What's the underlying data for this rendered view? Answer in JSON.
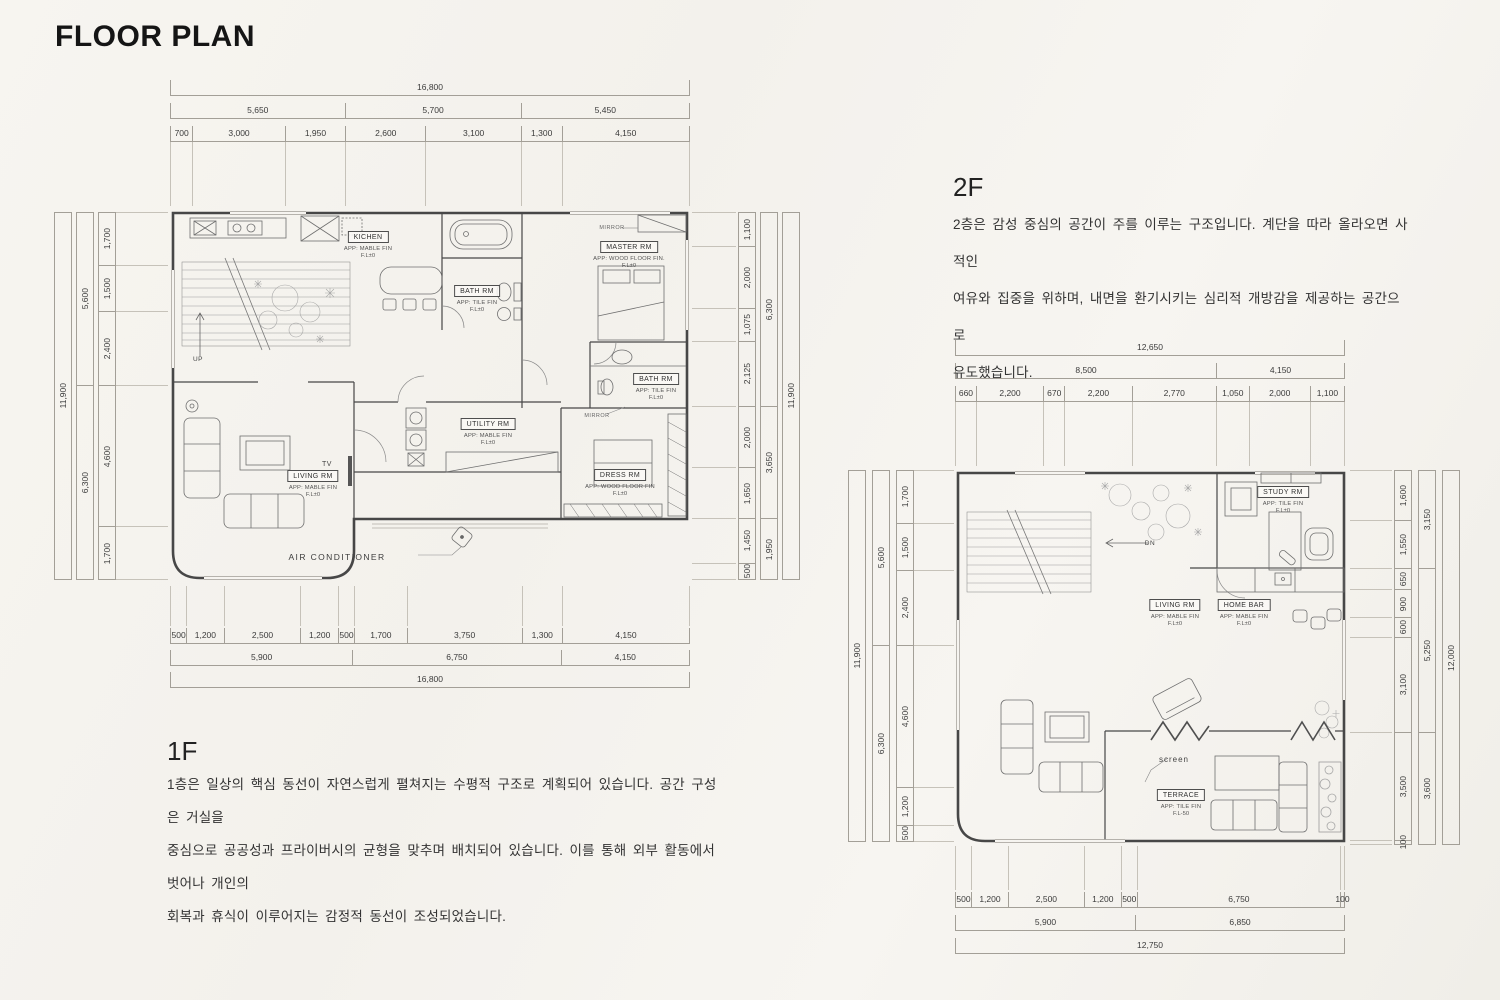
{
  "page": {
    "title": "FLOOR PLAN"
  },
  "floor1": {
    "heading": "1F",
    "description": "1층은 일상의 핵심 동선이 자연스럽게 펼쳐지는 수평적 구조로 계획되어 있습니다. 공간 구성은 거실을\n중심으로 공공성과 프라이버시의 균형을 맞추며 배치되어 있습니다. 이를 통해 외부 활동에서 벗어나 개인의\n회복과 휴식이 이루어지는 감정적 동선이 조성되었습니다.",
    "rooms": [
      {
        "name": "KICHEN",
        "fin": "APP: MABLE FIN",
        "lvl": "F.L±0"
      },
      {
        "name": "BATH RM",
        "fin": "APP: TILE FIN",
        "lvl": "F.L±0"
      },
      {
        "name": "MASTER RM",
        "fin": "APP: WOOD FLOOR FIN.",
        "lvl": "F.L±0"
      },
      {
        "name": "BATH RM",
        "fin": "APP: TILE FIN",
        "lvl": "F.L±0"
      },
      {
        "name": "UTILITY RM",
        "fin": "APP: MABLE FIN",
        "lvl": "F.L±0"
      },
      {
        "name": "LIVING RM",
        "fin": "APP: MABLE FIN",
        "lvl": "F.L±0"
      },
      {
        "name": "DRESS RM",
        "fin": "APP: WOOD FLOOR FIN",
        "lvl": "F.L±0"
      }
    ],
    "ann": {
      "up": "UP",
      "tv": "TV",
      "mirror_top": "MIRROR",
      "mirror_mid": "MIRROR",
      "aircon": "AIR CONDITIONER"
    },
    "dims": {
      "top_total": [
        {
          "t": "16,800",
          "s": 16800
        }
      ],
      "top_group": [
        {
          "t": "5,650",
          "s": 5650
        },
        {
          "t": "5,700",
          "s": 5700
        },
        {
          "t": "5,450",
          "s": 5450
        }
      ],
      "top_detail": [
        {
          "t": "700",
          "s": 700
        },
        {
          "t": "3,000",
          "s": 3000
        },
        {
          "t": "1,950",
          "s": 1950
        },
        {
          "t": "2,600",
          "s": 2600
        },
        {
          "t": "3,100",
          "s": 3100
        },
        {
          "t": "1,300",
          "s": 1300
        },
        {
          "t": "4,150",
          "s": 4150
        }
      ],
      "bottom_detail": [
        {
          "t": "500",
          "s": 500
        },
        {
          "t": "1,200",
          "s": 1200
        },
        {
          "t": "2,500",
          "s": 2500
        },
        {
          "t": "1,200",
          "s": 1200
        },
        {
          "t": "500",
          "s": 500
        },
        {
          "t": "1,700",
          "s": 1700
        },
        {
          "t": "3,750",
          "s": 3750
        },
        {
          "t": "1,300",
          "s": 1300
        },
        {
          "t": "4,150",
          "s": 4150
        }
      ],
      "bottom_group": [
        {
          "t": "5,900",
          "s": 5900
        },
        {
          "t": "6,750",
          "s": 6750
        },
        {
          "t": "4,150",
          "s": 4150
        }
      ],
      "bottom_total": [
        {
          "t": "16,800",
          "s": 16800
        }
      ],
      "left_total": [
        {
          "t": "11,900",
          "s": 11900
        }
      ],
      "left_group": [
        {
          "t": "5,600",
          "s": 5600
        },
        {
          "t": "6,300",
          "s": 6300
        }
      ],
      "left_detail": [
        {
          "t": "1,700",
          "s": 1700
        },
        {
          "t": "1,500",
          "s": 1500
        },
        {
          "t": "2,400",
          "s": 2400
        },
        {
          "t": "4,600",
          "s": 4600
        },
        {
          "t": "1,700",
          "s": 1700
        }
      ],
      "right_detail": [
        {
          "t": "1,100",
          "s": 1100
        },
        {
          "t": "2,000",
          "s": 2000
        },
        {
          "t": "1,075",
          "s": 1075
        },
        {
          "t": "2,125",
          "s": 2125
        },
        {
          "t": "2,000",
          "s": 2000
        },
        {
          "t": "1,650",
          "s": 1650
        },
        {
          "t": "1,450",
          "s": 1450
        },
        {
          "t": "500",
          "s": 500
        }
      ],
      "right_group": [
        {
          "t": "6,300",
          "s": 6300
        },
        {
          "t": "3,650",
          "s": 3650
        },
        {
          "t": "1,950",
          "s": 1950
        }
      ],
      "right_total": [
        {
          "t": "11,900",
          "s": 11900
        }
      ]
    }
  },
  "floor2": {
    "heading": "2F",
    "description": "2층은 감성 중심의 공간이 주를 이루는 구조입니다. 계단을 따라 올라오면 사적인\n여유와 집중을 위하며, 내면을 환기시키는 심리적 개방감을 제공하는 공간으로\n유도했습니다.",
    "rooms": [
      {
        "name": "STUDY RM",
        "fin": "APP: TILE FIN",
        "lvl": "F.L±0"
      },
      {
        "name": "LIVING RM",
        "fin": "APP: MABLE FIN",
        "lvl": "F.L±0"
      },
      {
        "name": "HOME BAR",
        "fin": "APP: MABLE FIN",
        "lvl": "F.L±0"
      },
      {
        "name": "TERRACE",
        "fin": "APP: TILE FIN",
        "lvl": "F.L-50"
      }
    ],
    "ann": {
      "dn": "DN",
      "screen": "screen"
    },
    "dims": {
      "top_total": [
        {
          "t": "12,650",
          "s": 12650
        }
      ],
      "top_group": [
        {
          "t": "8,500",
          "s": 8500
        },
        {
          "t": "4,150",
          "s": 4150
        }
      ],
      "top_detail": [
        {
          "t": "660",
          "s": 660
        },
        {
          "t": "2,200",
          "s": 2200
        },
        {
          "t": "670",
          "s": 670
        },
        {
          "t": "2,200",
          "s": 2200
        },
        {
          "t": "2,770",
          "s": 2770
        },
        {
          "t": "1,050",
          "s": 1050
        },
        {
          "t": "2,000",
          "s": 2000
        },
        {
          "t": "1,100",
          "s": 1100
        }
      ],
      "bottom_detail": [
        {
          "t": "500",
          "s": 500
        },
        {
          "t": "1,200",
          "s": 1200
        },
        {
          "t": "2,500",
          "s": 2500
        },
        {
          "t": "1,200",
          "s": 1200
        },
        {
          "t": "500",
          "s": 500
        },
        {
          "t": "6,750",
          "s": 6750
        },
        {
          "t": "100",
          "s": 100
        }
      ],
      "bottom_group": [
        {
          "t": "5,900",
          "s": 5900
        },
        {
          "t": "6,850",
          "s": 6850
        }
      ],
      "bottom_total": [
        {
          "t": "12,750",
          "s": 12750
        }
      ],
      "left_total": [
        {
          "t": "11,900",
          "s": 11900
        }
      ],
      "left_group": [
        {
          "t": "5,600",
          "s": 5600
        },
        {
          "t": "6,300",
          "s": 6300
        }
      ],
      "left_detail": [
        {
          "t": "1,700",
          "s": 1700
        },
        {
          "t": "1,500",
          "s": 1500
        },
        {
          "t": "2,400",
          "s": 2400
        },
        {
          "t": "4,600",
          "s": 4600
        },
        {
          "t": "1,200",
          "s": 1200
        },
        {
          "t": "500",
          "s": 500
        }
      ],
      "right_detail": [
        {
          "t": "1,600",
          "s": 1600
        },
        {
          "t": "1,550",
          "s": 1550
        },
        {
          "t": "650",
          "s": 650
        },
        {
          "t": "900",
          "s": 900
        },
        {
          "t": "600",
          "s": 600
        },
        {
          "t": "3,100",
          "s": 3100
        },
        {
          "t": "3,500",
          "s": 3500
        },
        {
          "t": "100",
          "s": 100
        }
      ],
      "right_group": [
        {
          "t": "3,150",
          "s": 3150
        },
        {
          "t": "5,250",
          "s": 5250
        },
        {
          "t": "3,600",
          "s": 3600
        }
      ],
      "right_total": [
        {
          "t": "12,000",
          "s": 12000
        }
      ]
    }
  }
}
